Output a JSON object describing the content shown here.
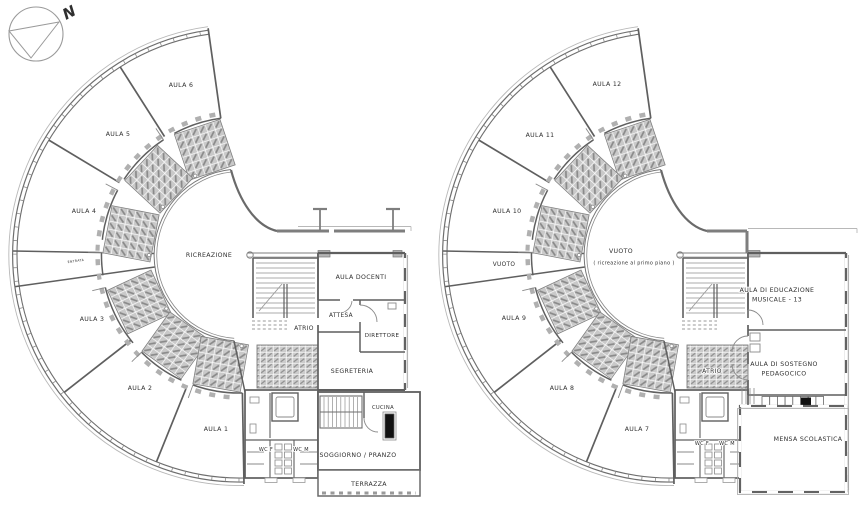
{
  "drawing": {
    "type": "architectural floor plans",
    "compass": {
      "label": "N"
    },
    "colors": {
      "wall": "#5f5f5f",
      "wall_light": "#8a8a8a",
      "roof": "#b8b8b8",
      "hatch_fill": "#c9c9c9",
      "hatch_line": "#8a8a8a",
      "text": "#2f2f2f",
      "appliance_black": "#111111"
    }
  },
  "plans": [
    {
      "name": "left-floor-plan",
      "rooms": [
        {
          "id": "aula-6",
          "label": "AULA 6",
          "x": 181,
          "y": 87
        },
        {
          "id": "aula-5",
          "label": "AULA 5",
          "x": 118,
          "y": 136
        },
        {
          "id": "aula-4",
          "label": "AULA 4",
          "x": 84,
          "y": 213
        },
        {
          "id": "aula-3",
          "label": "AULA 3",
          "x": 92,
          "y": 321
        },
        {
          "id": "aula-2",
          "label": "AULA 2",
          "x": 140,
          "y": 390
        },
        {
          "id": "aula-1",
          "label": "AULA 1",
          "x": 216,
          "y": 431
        },
        {
          "id": "ricreazione",
          "label": "RICREAZIONE",
          "x": 209,
          "y": 257
        },
        {
          "id": "aula-docenti",
          "label": "AULA DOCENTI",
          "x": 361,
          "y": 279
        },
        {
          "id": "attesa",
          "label": "ATTESA",
          "x": 341,
          "y": 317
        },
        {
          "id": "direttore",
          "label": "DIRETTORE",
          "x": 382,
          "y": 337
        },
        {
          "id": "atrio",
          "label": "ATRIO",
          "x": 304,
          "y": 330
        },
        {
          "id": "segreteria",
          "label": "SEGRETERIA",
          "x": 352,
          "y": 373
        },
        {
          "id": "cucina",
          "label": "CUCINA",
          "x": 383,
          "y": 409
        },
        {
          "id": "wc-f",
          "label": "WC F",
          "x": 266,
          "y": 451
        },
        {
          "id": "wc-m",
          "label": "WC M",
          "x": 301,
          "y": 451
        },
        {
          "id": "soggiorno-pranzo",
          "label": "SOGGIORNO / PRANZO",
          "x": 358,
          "y": 457
        },
        {
          "id": "terrazza",
          "label": "TERRAZZA",
          "x": 369,
          "y": 486
        },
        {
          "id": "entrata",
          "label": "ENTRATA",
          "x": 76,
          "y": 262
        }
      ]
    },
    {
      "name": "right-floor-plan",
      "rooms": [
        {
          "id": "aula-12",
          "label": "AULA 12",
          "x": 177,
          "y": 86
        },
        {
          "id": "aula-11",
          "label": "AULA 11",
          "x": 110,
          "y": 137
        },
        {
          "id": "aula-10",
          "label": "AULA 10",
          "x": 77,
          "y": 213
        },
        {
          "id": "vuoto",
          "label": "VUOTO",
          "x": 74,
          "y": 266
        },
        {
          "id": "aula-9",
          "label": "AULA 9",
          "x": 84,
          "y": 320
        },
        {
          "id": "aula-8",
          "label": "AULA 8",
          "x": 132,
          "y": 390
        },
        {
          "id": "aula-7",
          "label": "AULA 7",
          "x": 207,
          "y": 431
        },
        {
          "id": "vuoto-centro",
          "label": "VUOTO",
          "sublabel": "( ricreazione al primo piano )",
          "x": 191,
          "y": 253
        },
        {
          "id": "educazione-musicale",
          "lines": [
            "AULA DI EDUCAZIONE",
            "MUSICALE - 13"
          ],
          "x": 347,
          "y": 292
        },
        {
          "id": "atrio",
          "label": "ATRIO",
          "x": 282,
          "y": 373
        },
        {
          "id": "sostegno-pedagogico",
          "lines": [
            "AULA DI SOSTEGNO",
            "PEDAGOCICO"
          ],
          "x": 354,
          "y": 366
        },
        {
          "id": "wc-f",
          "label": "WC F",
          "x": 272,
          "y": 445
        },
        {
          "id": "wc-m",
          "label": "WC M",
          "x": 297,
          "y": 445
        },
        {
          "id": "mensa-scolastica",
          "label": "MENSA SCOLASTICA",
          "x": 378,
          "y": 441
        }
      ]
    }
  ]
}
